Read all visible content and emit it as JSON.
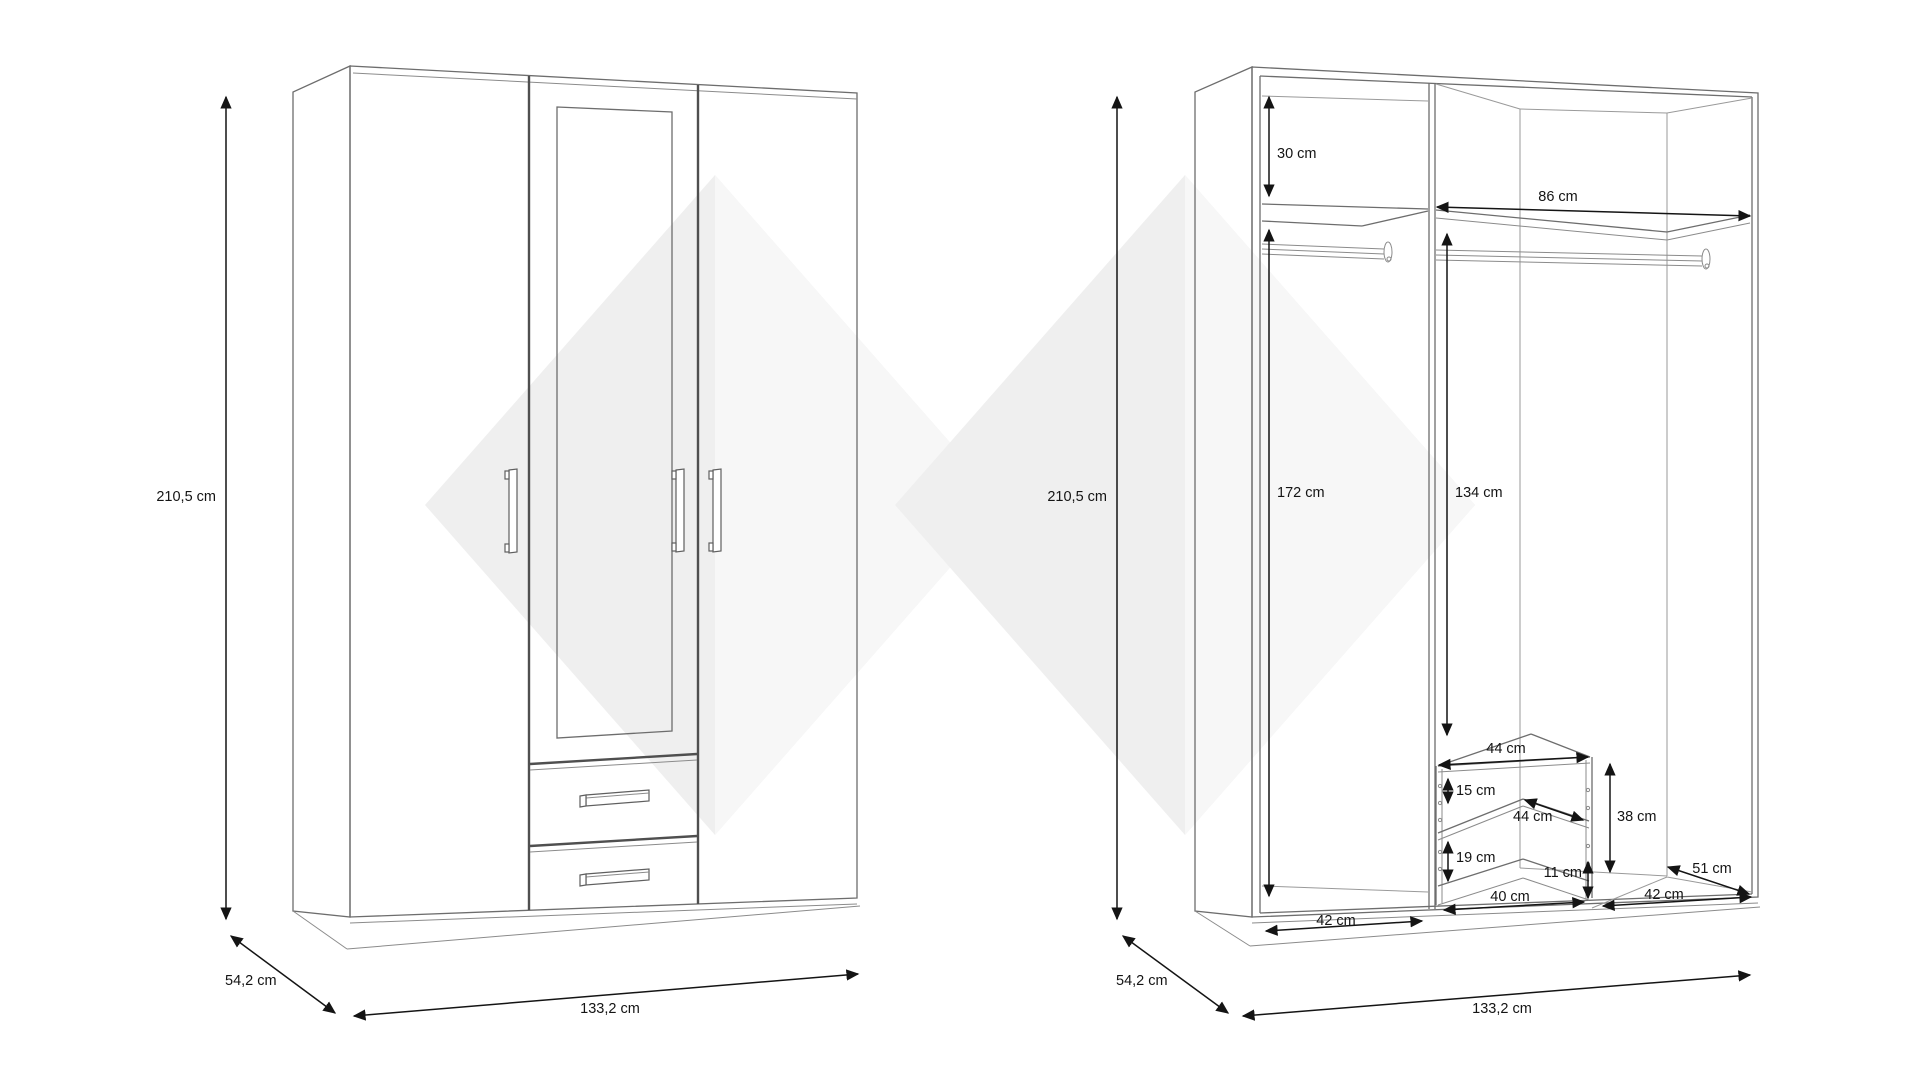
{
  "diagram": {
    "title": "wardrobe-technical-drawing",
    "views": {
      "exterior": {
        "height": "210,5 cm",
        "depth": "54,2 cm",
        "width": "133,2 cm"
      },
      "interior": {
        "height": "210,5 cm",
        "depth": "54,2 cm",
        "width": "133,2 cm",
        "top_shelf_offset": "30 cm",
        "right_section_width": "86 cm",
        "left_section_clear_height": "172 cm",
        "hanging_clearance": "134 cm",
        "left_section_floor_width": "42 cm",
        "drawer_top_width": "44 cm",
        "drawer_top_gap": "15 cm",
        "drawer_depth": "44 cm",
        "drawer_unit_height": "38 cm",
        "drawer_lower_gap": "19 cm",
        "drawer_base_height": "11 cm",
        "drawer_bottom_width": "40 cm",
        "right_floor_depth": "51 cm",
        "right_floor_width": "42 cm"
      }
    }
  }
}
